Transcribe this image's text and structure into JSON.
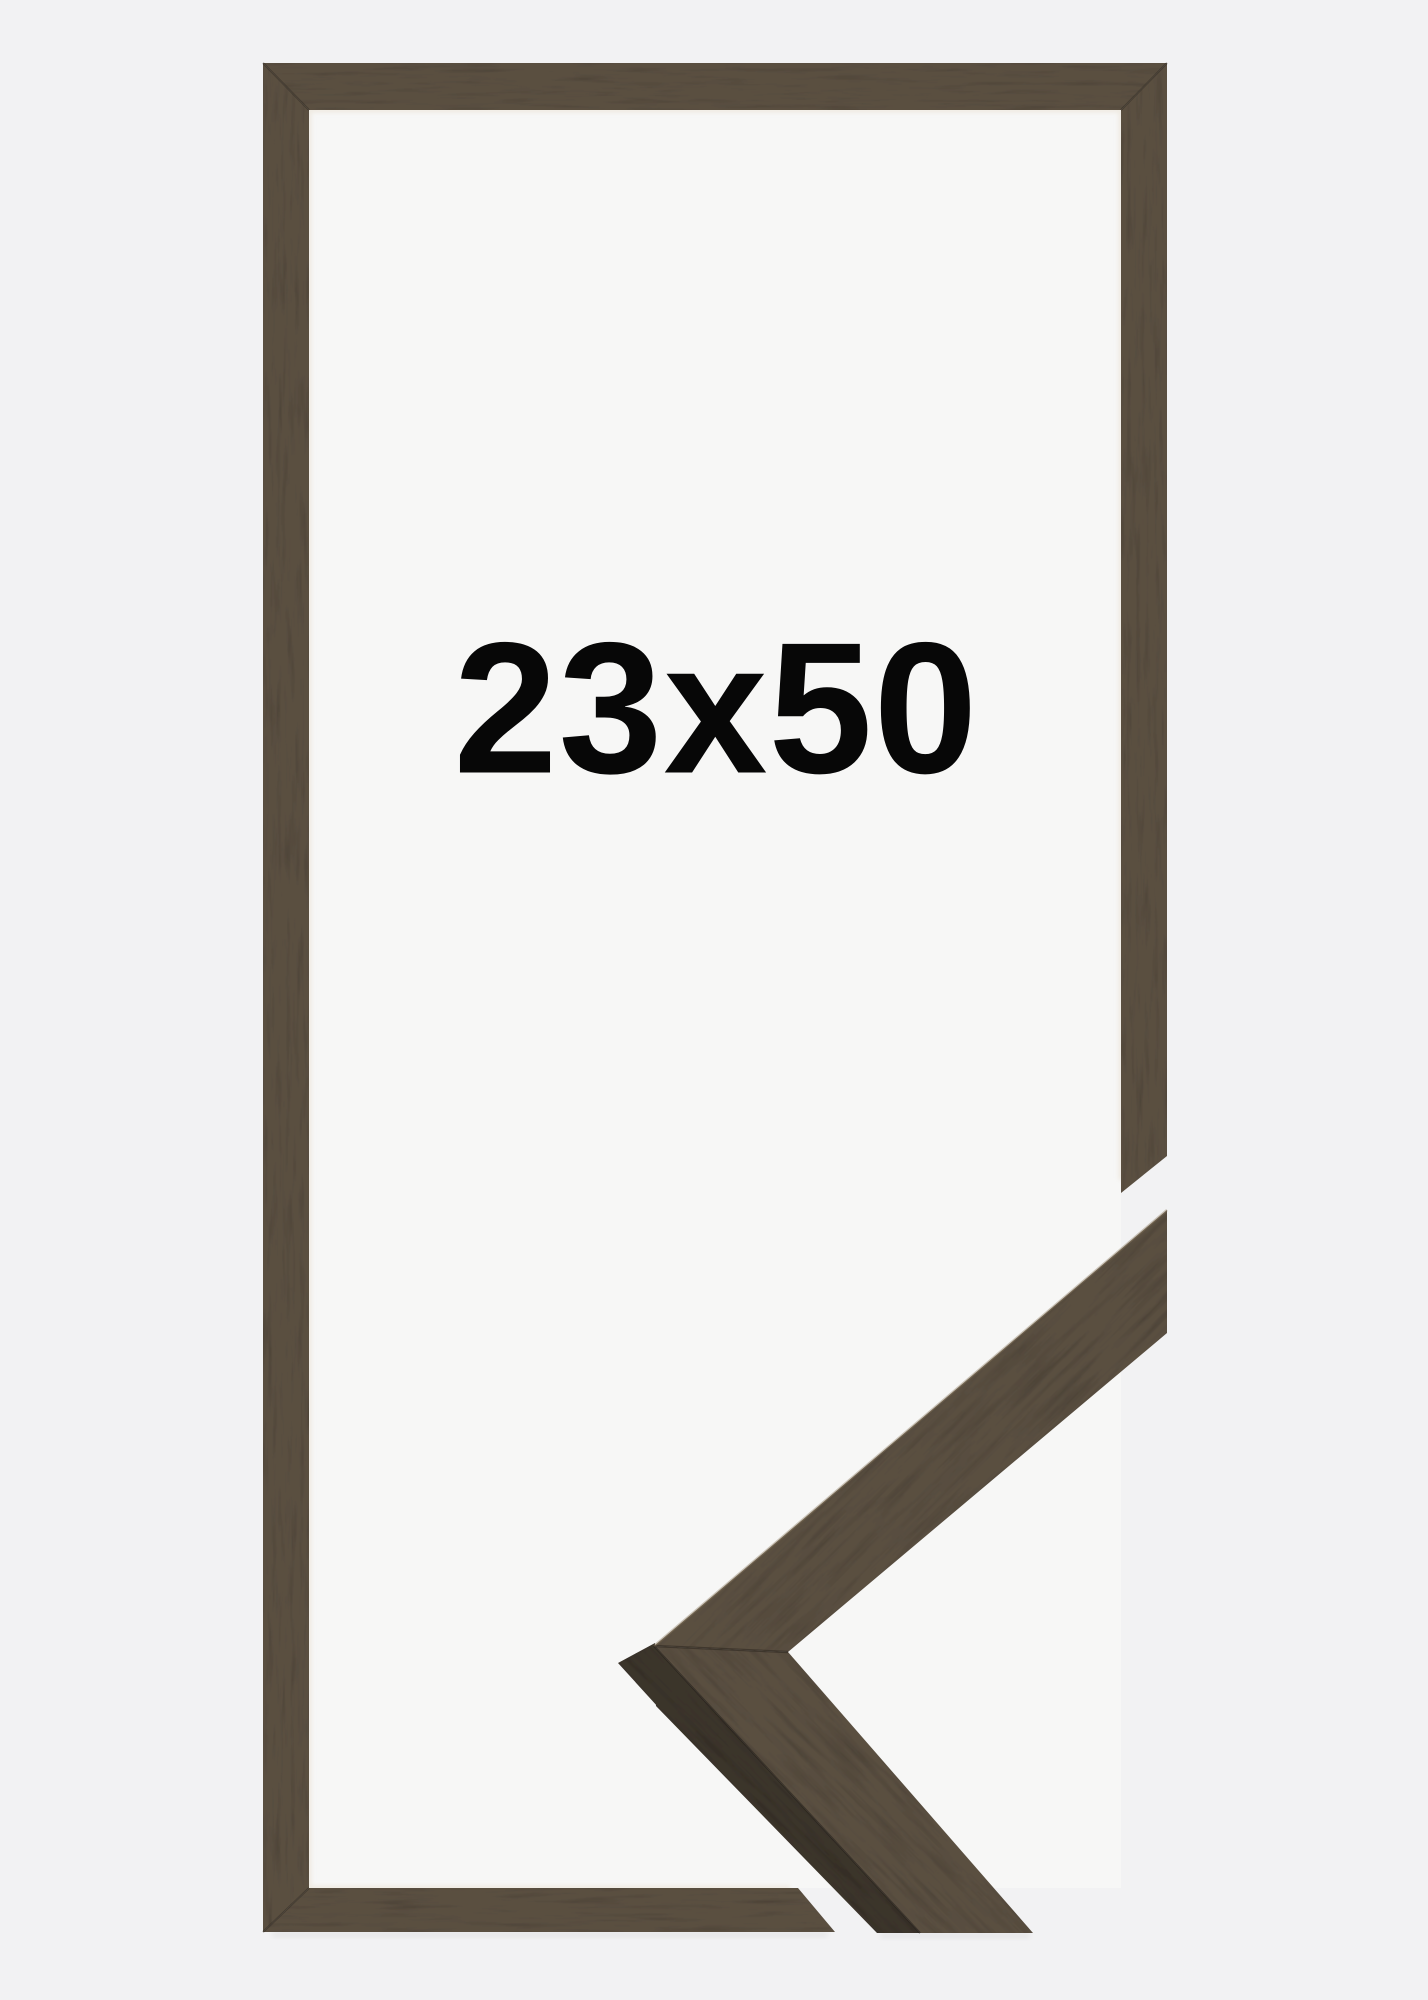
{
  "product": {
    "size_label": "23x50"
  },
  "image": {
    "description": "Dark brown walnut wooden picture frame shown flat with lower-right corner cut away, and a 3D close-up sample of the mitered frame corner profile placed in the lower right",
    "frame_material": "walnut wood grain",
    "corner_detail": "mitered corner profile sample"
  },
  "colors": {
    "background": "#f2f2f3",
    "backing": "#f7f7f6",
    "wood_base": "#5a4f41",
    "wood_dark_side": "#3b342b",
    "inner_shadow": "#e8dfd0",
    "seam": "#2b251e",
    "label_text": "#070707"
  }
}
